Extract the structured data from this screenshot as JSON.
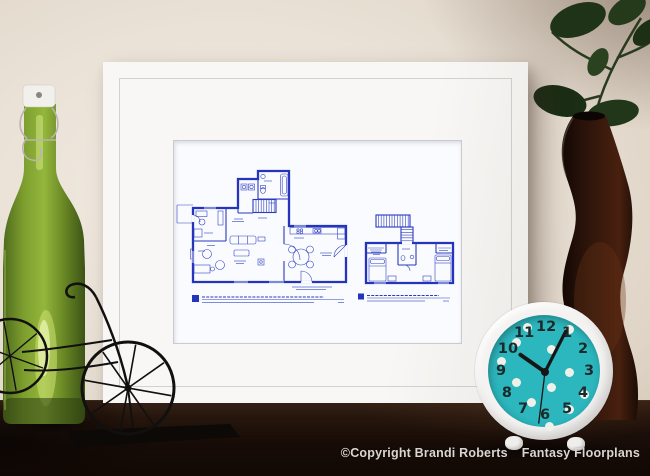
{
  "photo": {
    "copyright": "©Copyright Brandi Roberts",
    "brand": "Fantasy Floorplans"
  },
  "artwork": {
    "kind": "framed blueprint floor plan print",
    "plans": [
      "first-floor-plan",
      "second-floor-plan"
    ],
    "ink_color": "#2434bd",
    "paper_color": "#fafbfe",
    "mat_color": "#f6f5f2"
  },
  "clock": {
    "numerals": [
      "12",
      "1",
      "2",
      "3",
      "4",
      "5",
      "6",
      "7",
      "8",
      "9",
      "10",
      "11"
    ],
    "time": {
      "hour_angle_deg": 305,
      "minute_angle_deg": 27,
      "second_angle_deg": 187
    },
    "rim_color": "#f4f3f1",
    "face_color": "#2cb6bd",
    "numeral_color": "#1d2a2b",
    "hand_color": "#161616",
    "dot_color": "#eef1ea",
    "dots": [
      [
        52,
        25
      ],
      [
        94,
        27
      ],
      [
        41,
        40
      ],
      [
        76,
        47
      ],
      [
        26,
        59
      ],
      [
        94,
        70
      ],
      [
        41,
        80
      ],
      [
        76,
        85
      ],
      [
        109,
        92
      ],
      [
        56,
        100
      ],
      [
        94,
        107
      ],
      [
        74,
        124
      ]
    ]
  },
  "scene_objects": {
    "bottle": "green swing-top glass bottle",
    "bike": "black wire bicycle figurine",
    "vase": "dark brown curved vase with leaves",
    "clock": "teal polka-dot table clock"
  },
  "colors": {
    "wall": "#eae2d7",
    "table": "#1d1009",
    "bottle_green": "#7fa02c",
    "vase_brown": "#2a130a",
    "leaf_green": "#22351a",
    "copyright_text": "#d8d5d2"
  }
}
